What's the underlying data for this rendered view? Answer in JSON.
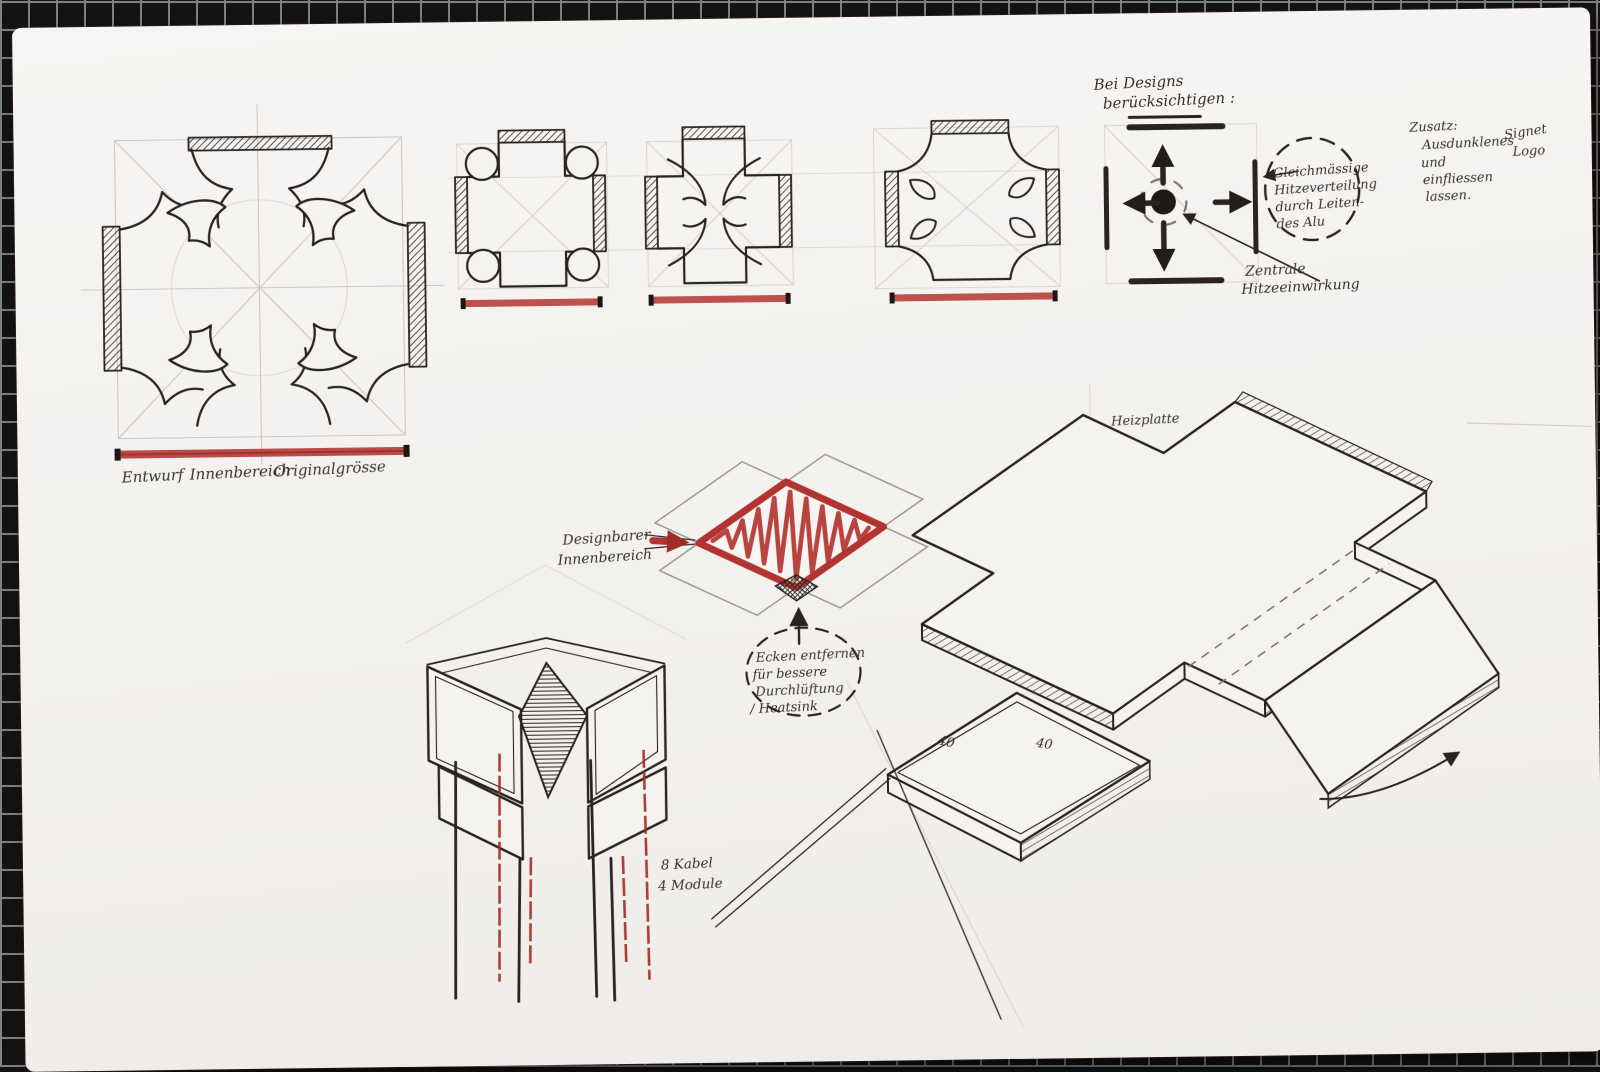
{
  "colors": {
    "paper": "#f4f2ef",
    "ink": "#2b2320",
    "pencil": "#c6c0b8",
    "red": "#b23430",
    "tile": "#141414",
    "grout": "#9f9f9f"
  },
  "captions": {
    "entwurf": "Entwurf",
    "innenbereich": "Innenbereich",
    "originalgroesse": "Originalgrösse"
  },
  "notes": {
    "bei_designs": {
      "line1": "Bei Designs",
      "line2": "berücksichtigen :"
    },
    "heat_bubble": {
      "lines": [
        "Gleichmässige",
        "Hitzeverteilung",
        "durch Leiten-",
        "des Alu"
      ]
    },
    "zentrale": {
      "line1": "Zentrale",
      "line2": "Hitzeeinwirkung"
    },
    "zusatz": {
      "title": "Zusatz:",
      "line1": "Ausdunklenes",
      "signet": "Signet",
      "logo": "Logo",
      "line2": "und",
      "line3": "einfliessen",
      "line4": "lassen."
    },
    "designbar": {
      "line1": "Designbarer",
      "line2": "Innenbereich"
    },
    "ecken_bubble": {
      "lines": [
        "Ecken entfernen",
        "für bessere",
        "Durchlüftung",
        "/ Heatsink"
      ]
    },
    "heizplatte": "Heizplatte",
    "kabel": {
      "line1": "8 Kabel",
      "line2": "4 Module"
    },
    "dims": {
      "left": "40",
      "right": "40"
    }
  }
}
